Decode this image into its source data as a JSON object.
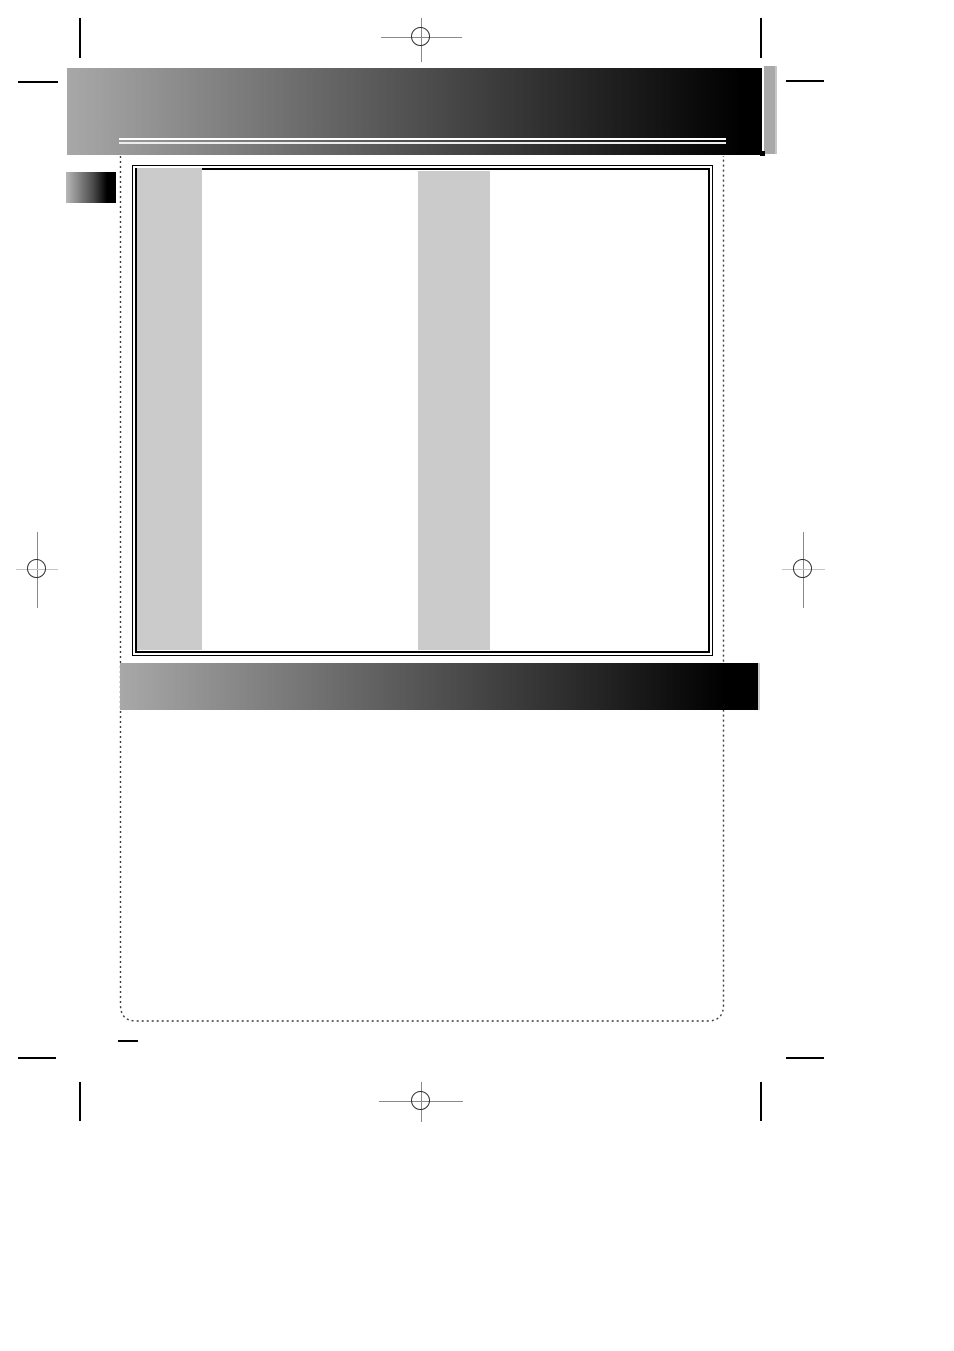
{
  "document": {
    "kind": "print-ready manual page (prepress proof)",
    "visible_text": [],
    "header_bar": {
      "style": "gray-to-black gradient",
      "rule": "double white rule near bottom"
    },
    "section_bar": {
      "style": "gray-to-black gradient"
    },
    "content_frame": {
      "border": "double black border",
      "placeholder_columns": 2
    },
    "page_boundary": {
      "style": "dotted line, rounded bottom corners"
    },
    "printer_marks": {
      "registration_marks": [
        "top-center",
        "left-middle",
        "right-middle",
        "bottom-center"
      ],
      "crop_marks": [
        "top-left",
        "top-right",
        "bottom-left",
        "bottom-right",
        "fold-mark-bottom-left"
      ]
    }
  },
  "colors": {
    "page-bg": "#ffffff",
    "bar-start": "#a8a8a8",
    "bar-end": "#000000",
    "rule-top": "#ffffff",
    "rule-bottom": "#ededed",
    "column-fill": "#cbcbcb",
    "tab-fill": "#a9a9a9",
    "edge-light": "#c6c6c6",
    "box-border": "#000000",
    "crop-mark": "#000000",
    "reg-line": "#8a8a8a",
    "reg-line-light": "#c4c4c4",
    "reg-circle": "#2f2f2f",
    "dotted-line": "#3c3c3c"
  }
}
